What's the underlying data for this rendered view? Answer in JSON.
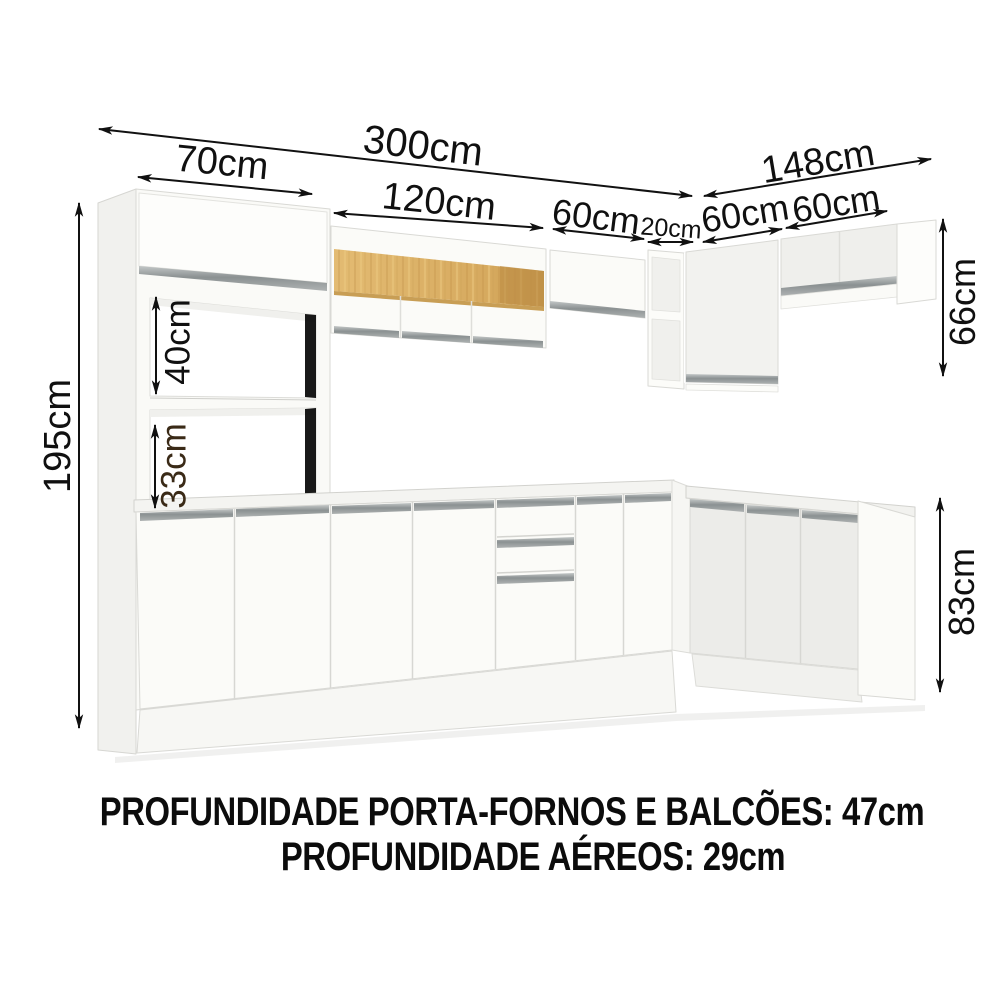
{
  "image_type": "kitchen-furniture-dimension-diagram",
  "dims": {
    "w300": "300cm",
    "w70": "70cm",
    "w120": "120cm",
    "w60a": "60cm",
    "w20": "20cm",
    "w60b": "60cm",
    "w60c": "60cm",
    "w148": "148cm",
    "h195": "195cm",
    "h40": "40cm",
    "h33": "33cm",
    "h66": "66cm",
    "h83": "83cm"
  },
  "notes": {
    "depth_line1": "PROFUNDIDADE PORTA-FORNOS E BALCÕES: 47cm",
    "depth_line2": "PROFUNDIDADE AÉREOS: 29cm"
  },
  "colors": {
    "text": "#101010",
    "accent_text": "#3a2a17",
    "wood": "#d9ad63",
    "handle": "#8f9596",
    "cabinet_white": "#fbfbf8"
  }
}
